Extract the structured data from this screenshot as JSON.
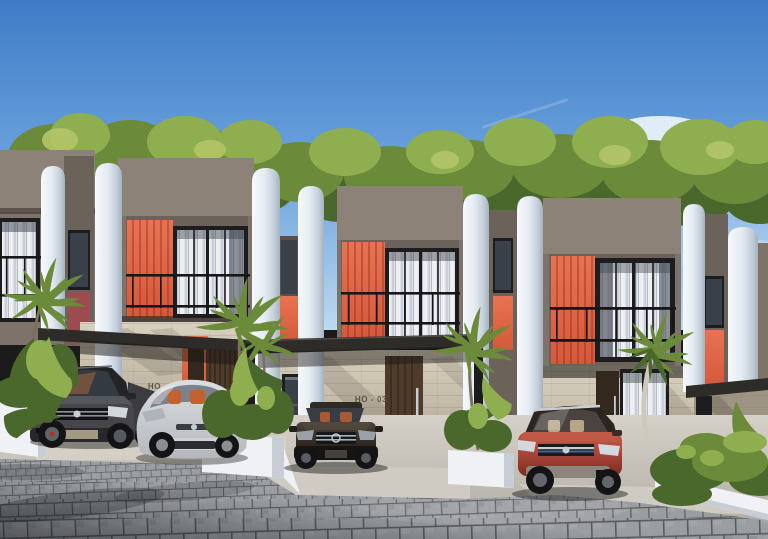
{
  "signs": {
    "unit_left": "HO - 02",
    "unit_center": "HO - 03"
  },
  "palette": {
    "sky-top": "#3f7cc7",
    "sky-mid": "#6fa6de",
    "sky-low": "#bcd9f0",
    "cloud": "#f7fafd",
    "tree-dark": "#4a672c",
    "tree-mid": "#6b8b3a",
    "tree-light": "#8fae50",
    "tree-pale": "#b3c468",
    "facade": "#7d736a",
    "facade-light": "#8d8278",
    "facade-dark": "#6b625a",
    "facade-deep": "#59514b",
    "pillar-light": "#f6f9fc",
    "pillar-mid": "#e5ebf2",
    "pillar-shade": "#c3ceda",
    "pillar-dark": "#a5b1bf",
    "accent": "#d5583b",
    "accent-dark": "#b23f27",
    "accent-light": "#e77352",
    "maroon": "#9c4b50",
    "frame": "#1d1d20",
    "glass": "#394049",
    "curtain-a": "#edeff2",
    "curtain-b": "#c9cfd8",
    "railing": "#17171a",
    "stone-light": "#d9d1bf",
    "stone": "#cbc2b0",
    "stone-shade": "#a79d8a",
    "stone-dark": "#9d9484",
    "wood": "#4e3b2b",
    "wood-dark": "#33281d",
    "canopy": "#2e2c29",
    "post": "#1c1c1e",
    "planter": "#eff1f4",
    "planter-shade": "#c7cdd4",
    "concrete-light": "#d5d1c8",
    "concrete-dark": "#aeaaa1",
    "paver": "#83868a",
    "paver-light": "#9b9ea1",
    "paver-joint": "#585b5f",
    "car-dark": "#46464a",
    "car-dark2": "#28282c",
    "car-white": "#dcdee1",
    "car-white-shade": "#b4b7bc",
    "car-sedan": "#362f27",
    "car-red": "#a8453a",
    "car-red-dark": "#7c2b21",
    "car-red-light": "#c25a47",
    "tire": "#141416",
    "chrome": "#c9ced3",
    "headlight": "#d3d8dc",
    "interior-orange": "#c4622f",
    "interior-tan": "#c9b794",
    "blue-strip": "#4a6fa8"
  }
}
